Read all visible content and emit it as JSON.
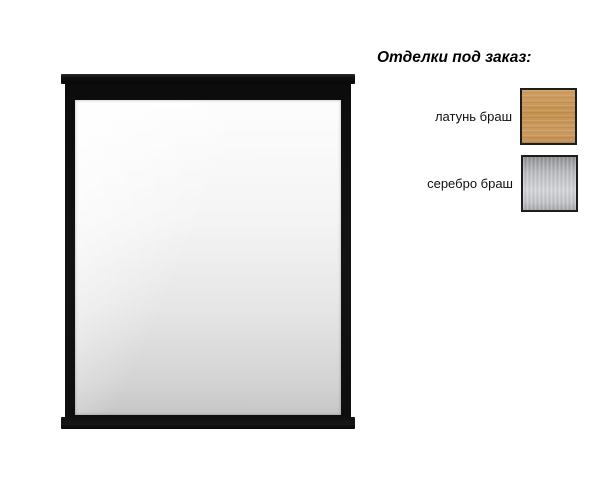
{
  "canvas": {
    "background": "#ffffff"
  },
  "mirror": {
    "description": "rectangular-mirror-black-frame-with-top-cornice",
    "frame_color": "#121212",
    "glass_gradient_top": "#fdfdfd",
    "glass_gradient_bottom": "#c6c6c6"
  },
  "finishes": {
    "heading": "Отделки под заказ:",
    "options": [
      {
        "label": "латунь браш",
        "finish": "brushed-brass",
        "color": "#c9995c"
      },
      {
        "label": "серебро браш",
        "finish": "brushed-silver",
        "color": "#c3c5c8"
      }
    ]
  }
}
